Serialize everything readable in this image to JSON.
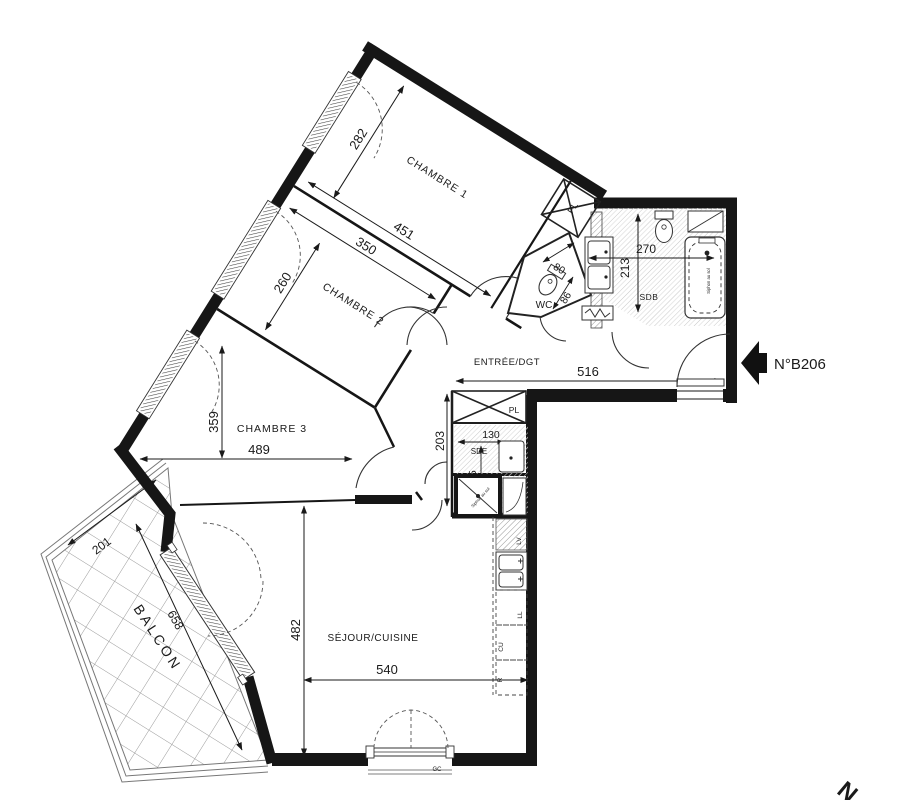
{
  "plan": {
    "unit": "N°B206",
    "compass_n": "N",
    "rooms": {
      "chambre1": "CHAMBRE 1",
      "chambre2": "CHAMBRE 2",
      "chambre3": "CHAMBRE 3",
      "entree": "ENTRÉE/DGT",
      "wc": "WC",
      "sdb": "SDB",
      "sde": "SDE",
      "sejour": "SÉJOUR/CUISINE",
      "balcon": "BALCON",
      "pl_hall": "PL",
      "pl_lower": "PL"
    },
    "dims": {
      "ch1_width": "451",
      "ch1_depth": "282",
      "ch2_width": "350",
      "ch2_depth": "260",
      "ch3_width": "489",
      "ch3_depth": "359",
      "entree_width": "516",
      "sdb_width": "270",
      "sdb_depth": "213",
      "wc_width": "80",
      "wc_depth": "86",
      "sde_width": "130",
      "sde_depth": "175",
      "hall_depth": "203",
      "sejour_width": "540",
      "sejour_depth": "482",
      "balcon_depth": "201",
      "balcon_length": "658"
    },
    "kitchen": {
      "lv": "LV",
      "ll": "LL",
      "cu": "CU",
      "r": "R"
    },
    "annotations": {
      "gc": "GC",
      "siphon_bath": "Siphon au sol",
      "siphon_shower": "Siphon au sol"
    },
    "colors": {
      "wall": "#161616",
      "line": "#2a2a2a",
      "hatch": "#bdbdbd"
    }
  }
}
